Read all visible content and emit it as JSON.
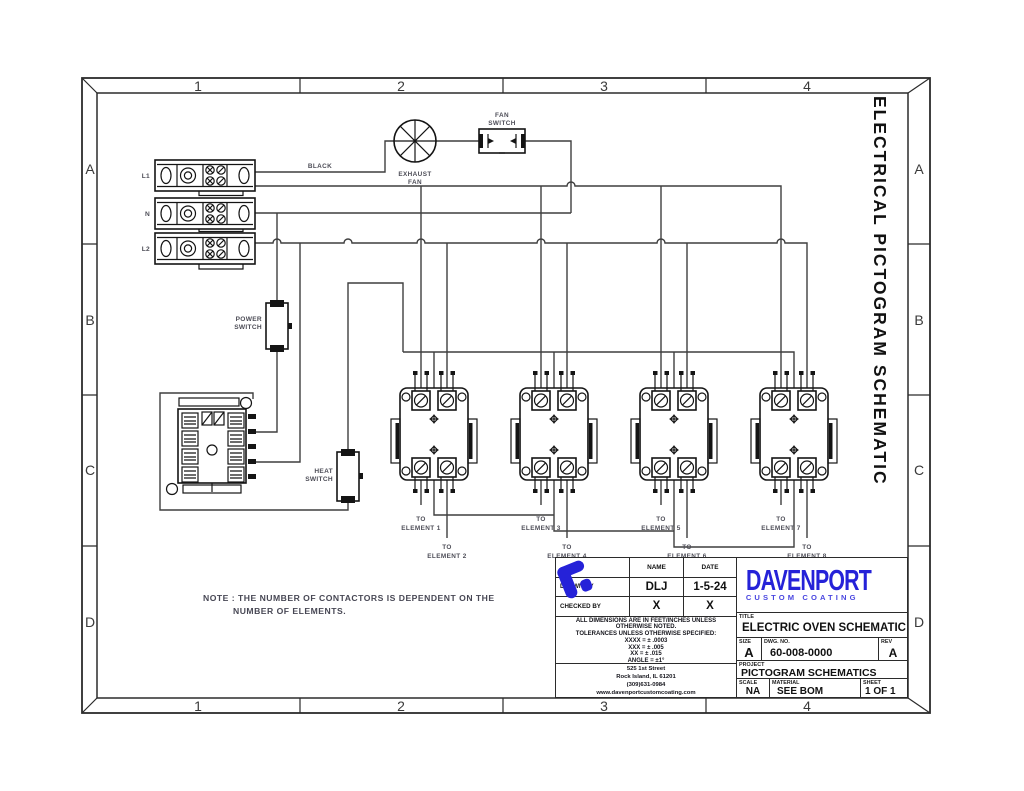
{
  "zones": {
    "columns": [
      "1",
      "2",
      "3",
      "4"
    ],
    "rows": [
      "A",
      "B",
      "C",
      "D"
    ]
  },
  "side_title": "ELECTRICAL PICTOGRAM SCHEMATIC",
  "schematic": {
    "terminals": [
      "L1",
      "N",
      "L2"
    ],
    "wire_label": "BLACK",
    "exhaust_fan": [
      "EXHAUST",
      "FAN"
    ],
    "fan_switch": [
      "FAN",
      "SWITCH"
    ],
    "power_switch": [
      "POWER",
      "SWITCH"
    ],
    "heat_switch": [
      "HEAT",
      "SWITCH"
    ],
    "to": "TO",
    "elements": [
      "ELEMENT 1",
      "ELEMENT 2",
      "ELEMENT 3",
      "ELEMENT 4",
      "ELEMENT 5",
      "ELEMENT 6",
      "ELEMENT 7",
      "ELEMENT 8"
    ]
  },
  "note": {
    "line1": "NOTE : THE NUMBER OF CONTACTORS IS DEPENDENT ON THE",
    "line2": "NUMBER OF ELEMENTS."
  },
  "title_block": {
    "name_header": "NAME",
    "date_header": "DATE",
    "drawn_by": {
      "label": "DRAWN BY",
      "name": "DLJ",
      "date": "1-5-24"
    },
    "checked_by": {
      "label": "CHECKED BY",
      "name": "X",
      "date": "X"
    },
    "tolerances": [
      "ALL DIMENSIONS ARE IN FEET/INCHES UNLESS",
      "OTHERWISE NOTED.",
      "TOLERANCES UNLESS OTHERWISE SPECIFIED:",
      "XXXX = ± .0003",
      "XXX = ± .005",
      "XX = ± .015",
      "ANGLE = ±1°"
    ],
    "address": [
      "525 1st Street",
      "Rock Island, IL 61201",
      "(309)631-0984",
      "www.davenportcustomcoating.com"
    ],
    "title": {
      "label": "TITLE",
      "value": "ELECTRIC OVEN SCHEMATIC"
    },
    "size": {
      "label": "SIZE",
      "value": "A"
    },
    "dwg_no": {
      "label": "DWG. NO.",
      "value": "60-008-0000"
    },
    "rev": {
      "label": "REV",
      "value": "A"
    },
    "project": {
      "label": "PROJECT",
      "value": "PICTOGRAM SCHEMATICS"
    },
    "scale": {
      "label": "SCALE",
      "value": "NA"
    },
    "material": {
      "label": "MATERIAL",
      "value": "SEE BOM"
    },
    "sheet": {
      "label": "SHEET",
      "value": "1 OF 1"
    },
    "logo": {
      "name": "DAVENPORT",
      "tagline": "CUSTOM COATING"
    }
  },
  "colors": {
    "logo_blue": "#2522d8",
    "wire": "#3f3f3f",
    "component": "#141414",
    "small_label": "#4d4d57"
  }
}
